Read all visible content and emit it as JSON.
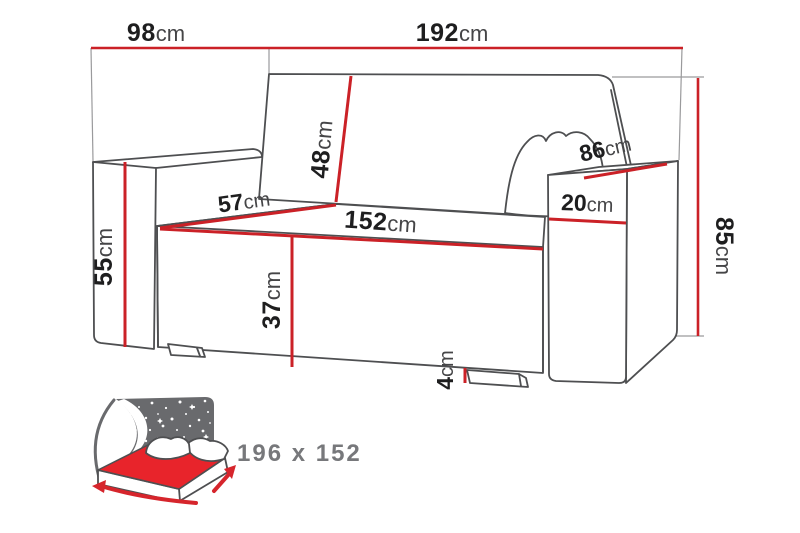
{
  "diagram": {
    "type": "furniture-dimension-diagram",
    "subject": "sofa-bed"
  },
  "dimensions": {
    "depth_overall": {
      "value": "98",
      "unit": "cm"
    },
    "width_overall": {
      "value": "192",
      "unit": "cm"
    },
    "height_overall": {
      "value": "85",
      "unit": "cm"
    },
    "armrest_height": {
      "value": "55",
      "unit": "cm"
    },
    "backrest_height": {
      "value": "48",
      "unit": "cm"
    },
    "seat_depth": {
      "value": "57",
      "unit": "cm"
    },
    "seat_width": {
      "value": "152",
      "unit": "cm"
    },
    "seat_height": {
      "value": "37",
      "unit": "cm"
    },
    "armrest_depth": {
      "value": "86",
      "unit": "cm"
    },
    "armrest_width": {
      "value": "20",
      "unit": "cm"
    },
    "leg_height": {
      "value": "4",
      "unit": "cm"
    }
  },
  "sleeping_area": {
    "label": "196 x 152"
  },
  "icons": {
    "sofa_bed_icon": "bed-with-starry-blanket-and-size-arrows"
  },
  "colors": {
    "dimension_red": "#cb2127",
    "mattress_red": "#e8242b",
    "outline_gray": "#4e4f51",
    "blanket_gray": "#696a6d",
    "bed_label_gray": "#77787b"
  }
}
